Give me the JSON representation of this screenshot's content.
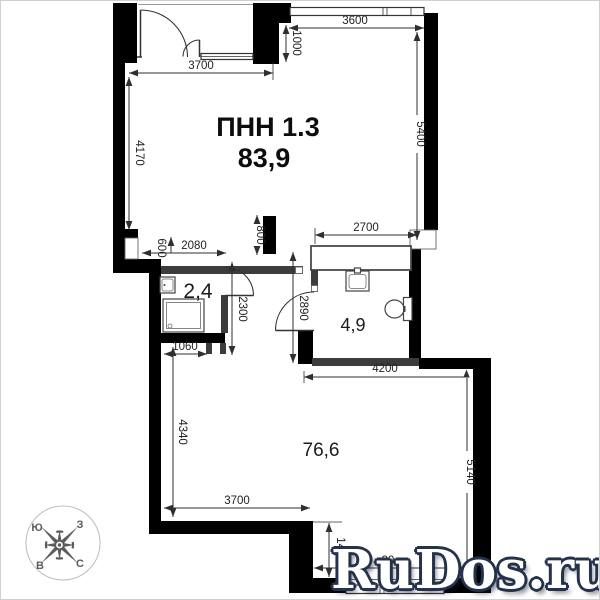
{
  "header": {
    "title": "ПНН 1.3",
    "total_area": "83,9"
  },
  "rooms": [
    {
      "id": "bathroom-small",
      "area": "2,4"
    },
    {
      "id": "bathroom",
      "area": "4,9"
    },
    {
      "id": "main-room",
      "area": "76,6"
    }
  ],
  "dims": {
    "top_3700": "3700",
    "top_1000": "1000",
    "top_3600": "3600",
    "left_4170": "4170",
    "right_5400": "5400",
    "mid_2700": "2700",
    "mid_800": "800",
    "mid_600": "600",
    "mid_2080": "2080",
    "right_2300": "2300",
    "left_2890": "2890",
    "bottom_1060": "1060",
    "left_4340": "4340",
    "mid_4200": "4200",
    "right_5140": "5140",
    "bottom_3700": "3700",
    "bottom_1400": "1400",
    "bottom_3900_partial": "39"
  },
  "compass": {
    "top_left": "Ю",
    "top_right": "З",
    "bottom_left": "В",
    "bottom_right": "С"
  },
  "watermark": {
    "text": "RuDos.ru"
  },
  "colors": {
    "wall": "#000000",
    "partition": "#3c3c3c",
    "dimension": "#2f2f2f",
    "watermark_fill": "#ffffff",
    "watermark_outline": "#26324b"
  }
}
